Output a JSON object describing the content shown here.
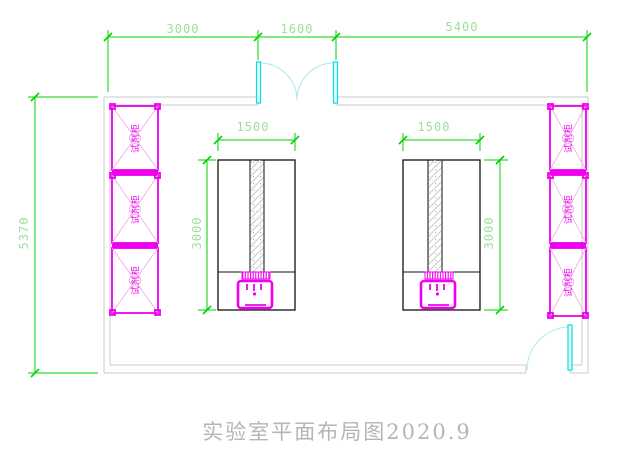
{
  "drawing": {
    "title": "实验室平面布局图2020.9"
  },
  "dimensions": {
    "top_left": "3000",
    "top_middle": "1600",
    "top_right": "5400",
    "left_overall": "5370",
    "bench_left_width": "1500",
    "bench_left_depth": "3000",
    "bench_right_width": "1500",
    "bench_right_depth": "3000"
  },
  "cabinets": {
    "label": "试剂柜"
  },
  "colors": {
    "dim_green": "#00d400",
    "dim_text_green": "#9cdf9c",
    "cabinet_magenta": "#ee00ee",
    "magenta_light": "#f2a2e8",
    "door_cyan": "#00e0e0",
    "cyan_light": "#a9e9e9",
    "wall_gray": "#cbcbcb",
    "bench_black": "#111111",
    "title_gray": "#b5b5b5"
  }
}
